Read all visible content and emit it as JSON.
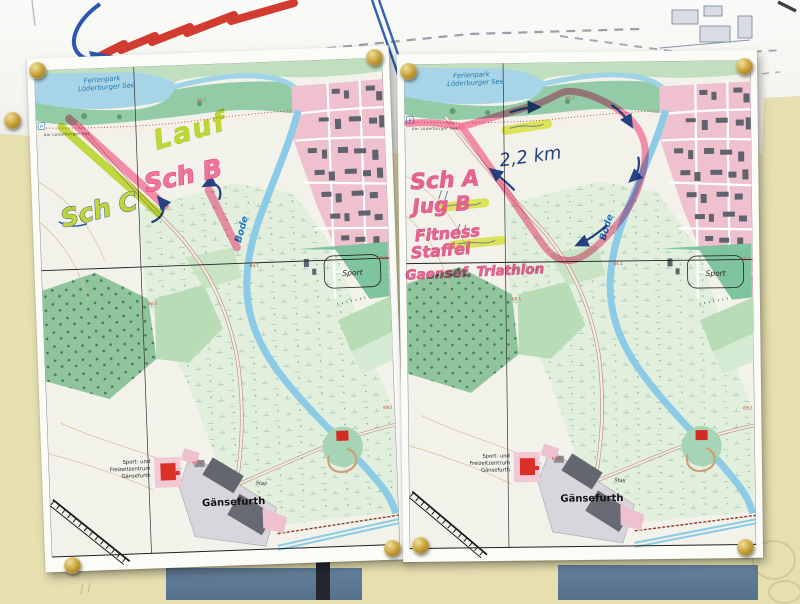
{
  "photo": {
    "wall_color": "#e6dfb0",
    "panel_color": "#5a7186",
    "pin_color": "#c49c34",
    "marker_red": "#d23b30",
    "pen_blue": "#27458f",
    "route_pink": "#ff7aa6",
    "route_green": "#c9e23c",
    "highlight_yellow": "#e6ef50",
    "town_pink": "#efc0cd",
    "water_blue": "#8ccbe6"
  },
  "base_map": {
    "ferienpark_line1": "Ferienpark",
    "ferienpark_line2": "Löderburger See",
    "shore_road": "Am Löderburger See",
    "parking": "P",
    "river": "Bode",
    "sport": "Sport",
    "freizeit_line1": "Sport- und",
    "freizeit_line2": "Freizeitzentrum",
    "freizeit_line3": "Gänsefurth",
    "village": "Gänsefurth",
    "stall": "Stall",
    "elev_1": "65.7",
    "elev_2": "68.1",
    "elev_3": "66.8",
    "elev_4": "64.1",
    "elev_5": "68.6",
    "elev_6": "65.2"
  },
  "left_map": {
    "annotations": {
      "lauf": "Lauf",
      "sch_b": "Sch B",
      "sch_c": "Sch C"
    }
  },
  "right_map": {
    "annotations": {
      "sch_a": "Sch A",
      "jug_b": "Jug B",
      "fitness": "Fitness",
      "staffel": "Staffel",
      "event": "Gaensef. Triathlon",
      "distance": "2,2 km"
    }
  }
}
